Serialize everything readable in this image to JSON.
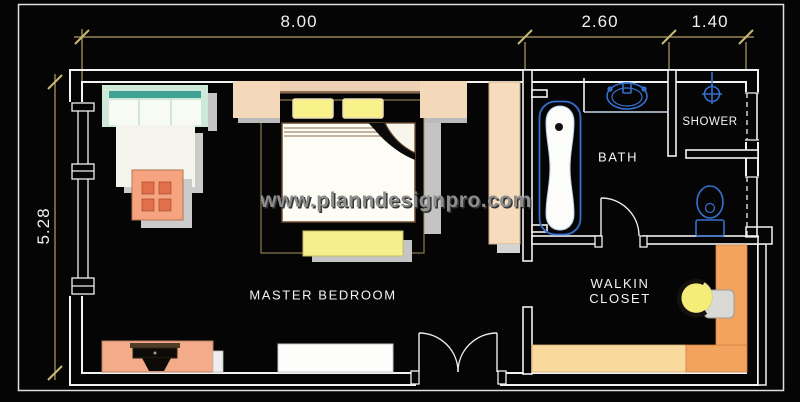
{
  "document": {
    "type": "floor-plan",
    "watermark": "www.planndesignpro.com"
  },
  "dimensions": {
    "top": [
      {
        "label": "8.00"
      },
      {
        "label": "2.60"
      },
      {
        "label": "1.40"
      }
    ],
    "left": [
      {
        "label": "5.28"
      }
    ]
  },
  "rooms": {
    "master_bedroom": {
      "label": "MASTER BEDROOM"
    },
    "bath": {
      "label": "BATH"
    },
    "shower": {
      "label": "SHOWER"
    },
    "walkin_closet": {
      "line1": "WALKIN",
      "line2": "CLOSET"
    }
  },
  "fixtures": {
    "icons": [
      "sofa",
      "rug",
      "coffee-table",
      "double-bed",
      "pillow",
      "nightstand",
      "foot-bench",
      "wardrobe",
      "tv-console",
      "dresser",
      "bathtub",
      "washbasin",
      "toilet",
      "shower-drain",
      "closet-shelves",
      "closet-chair",
      "double-entry-door",
      "swing-door",
      "window"
    ]
  },
  "colors": {
    "background": "#050505",
    "wall_line": "#f2f2f2",
    "dimension_line": "#b3a163",
    "fixture_blue": "#3570cf",
    "furniture_peach": "#f3d8ba",
    "furniture_salmon": "#f3ab8a",
    "furniture_yellow": "#f9f28b",
    "sofa_mint": "#cfe9d8",
    "sofa_teal": "#3fa294",
    "closet_orange": "#f2a45f",
    "closet_cream": "#f9d99e",
    "watermark_gray": "#8d8d8d"
  }
}
